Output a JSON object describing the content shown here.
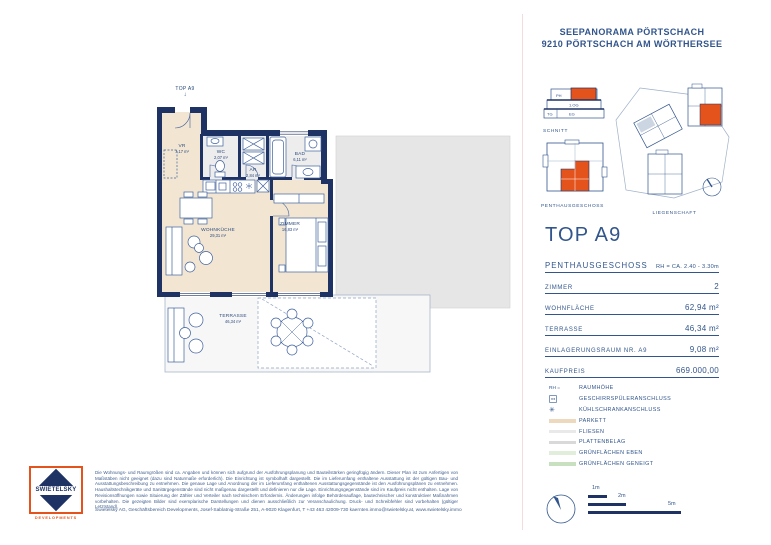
{
  "header": {
    "line1": "SEEPANORAMA PÖRTSCHACH",
    "line2": "9210 PÖRTSCHACH AM WÖRTHERSEE"
  },
  "diagrams": {
    "schnitt": {
      "caption": "SCHNITT",
      "levels": {
        "ph": "PH",
        "og1": "1.OG",
        "tg": "TG",
        "eg": "EG"
      }
    },
    "floorkey": {
      "caption": "PENTHAUSGESCHOSS"
    },
    "site": {
      "caption": "LIEGENSCHAFT"
    }
  },
  "unit": {
    "title": "TOP A9",
    "rows": [
      {
        "label": "PENTHAUSGESCHOSS",
        "value": "RH = CA. 2.40 - 3.30m"
      },
      {
        "label": "ZIMMER",
        "value": "2"
      },
      {
        "label": "WOHNFLÄCHE",
        "value": "62,94 m²"
      },
      {
        "label": "TERRASSE",
        "value": "46,34 m²"
      },
      {
        "label": "EINLAGERUNGSRAUM NR. A9",
        "value": "9,08 m²"
      },
      {
        "label": "KAUFPREIS",
        "value": "669.000,00"
      }
    ]
  },
  "legend": {
    "items": [
      {
        "symbol": "RH =",
        "label": "RAUMHÖHE"
      },
      {
        "symbol": "",
        "label": "GESCHIRRSPÜLERANSCHLUSS"
      },
      {
        "symbol": "✳",
        "label": "KÜHLSCHRANKANSCHLUSS"
      },
      {
        "label": "PARKETT",
        "style": "background:#edd9bd"
      },
      {
        "label": "FLIESEN",
        "style": "background:#e9e9e9"
      },
      {
        "label": "PLATTENBELAG",
        "style": "background:#d9d9d9"
      },
      {
        "label": "GRÜNFLÄCHEN EBEN",
        "style": "background:#e1eedc"
      },
      {
        "label": "GRÜNFLÄCHEN GENEIGT",
        "style": "background:#c8dfc0"
      }
    ]
  },
  "scale": {
    "m1": "1m",
    "m2": "2m",
    "m5": "5m"
  },
  "plan": {
    "entrance": "TOP A9",
    "rooms": [
      {
        "name": "VR",
        "area": "7,17 m²"
      },
      {
        "name": "WC",
        "area": "2,07 m²"
      },
      {
        "name": "AR",
        "area": "2,84 m²"
      },
      {
        "name": "BAD",
        "area": "6,11 m²"
      },
      {
        "name": "WOHNKÜCHE",
        "area": "29,31 m²"
      },
      {
        "name": "ZIMMER",
        "area": "16,83 m²"
      },
      {
        "name": "TERRASSE",
        "area": "46,34 m²"
      }
    ]
  },
  "logo": {
    "brand": "SWIETELSKY",
    "division": "DEVELOPMENTS"
  },
  "footer": {
    "disclaimer": "Die Wohnungs- und Raumgrößen sind ca. Angaben und können sich aufgrund der Ausführungsplanung und Bauteilstärken geringfügig ändern. Dieser Plan ist zum Anfertigen von Maßstäben nicht geeignet (dazu sind Naturmaße erforderlich). Die Einrichtung ist symbolhaft dargestellt. Die im Lieferumfang enthaltene Ausstattung ist der gültigen Bau- und Ausstattungsbeschreibung zu entnehmen. Die genaue Lage und Anordnung der im Lieferumfang enthaltenen Ausstattungsgegenstände ist den Ausführungsplänen zu entnehmen. Haushaltstechnikgeräte und Sanitärgegenstände sind nicht maßgenau dargestellt und definieren nur die Lage. Einrichtungsgegenstände sind im Kaufpreis nicht enthalten. Lage von Revisionsöffnungen sowie Situierung der Zähler und Verteiler nach technischem Erfordernis. Änderungen infolge Behördenauflage, bautechnischer und konstruktiver Maßnahmen vorbehalten. Die gezeigten Bilder sind exemplarische Darstellungen und dienen ausschließlich zur Veranschaulichung. Druck- und Schreibfehler sind vorbehalten (gültiger Letztstand).",
    "company": "Swietelsky AG, Geschäftsbereich Developments, Josef-Sablatnig-Straße 251, A-9020 Klagenfurt, T +43 463 42009-730 kaernten.immo@swietelsky.at, www.swietelsky.immo"
  },
  "colors": {
    "navy": "#1e3263",
    "text_navy": "#31558c",
    "orange": "#e5531c",
    "parkett": "#f2e6d3",
    "fliesen": "#ededed"
  }
}
